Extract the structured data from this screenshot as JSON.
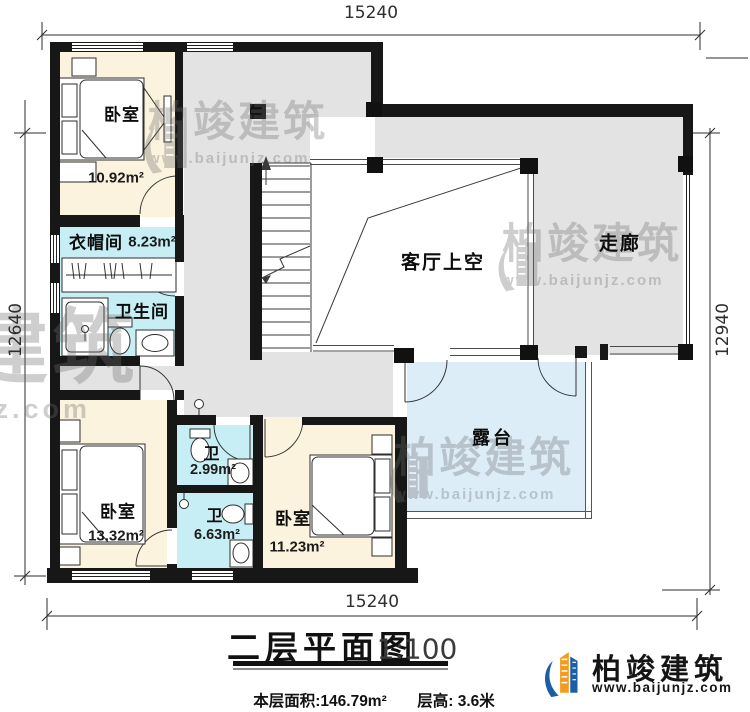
{
  "dimensions": {
    "top": "15240",
    "bottom": "15240",
    "left": "12640",
    "right": "12940"
  },
  "rooms": {
    "bedroom_top_left": {
      "name": "卧室",
      "area": "10.92m²"
    },
    "cloakroom": {
      "name": "衣帽间",
      "area": "8.23m²"
    },
    "bathroom": {
      "name": "卫生间"
    },
    "living_room_void": {
      "name": "客厅上空"
    },
    "corridor": {
      "name": "走廊"
    },
    "bedroom_bottom_left": {
      "name": "卧室",
      "area": "13.32m²"
    },
    "wc_upper": {
      "name": "卫",
      "area": "2.99m²"
    },
    "wc_lower": {
      "name": "卫",
      "area": "6.63m²"
    },
    "bedroom_bottom_right": {
      "name": "卧室",
      "area": "11.23m²"
    },
    "terrace": {
      "name": "露台"
    }
  },
  "title_block": {
    "title": "二层平面图",
    "scale": "1:100",
    "area_label": "本层面积:146.79m²",
    "height_label": "层高: 3.6米"
  },
  "logo": {
    "brand": "柏竣建筑",
    "site": "www.baijunjz.com"
  },
  "watermark": {
    "brand": "柏竣建筑",
    "site": "www.baijunjz.com"
  },
  "colors": {
    "wall": "#171717",
    "hall_gray": "#e3e3e3",
    "room_cream": "#fcf3de",
    "room_cyan": "#c8eef5",
    "terrace_blue": "#dcedf8",
    "logo_blue": "#1b5ea6",
    "logo_orange": "#f29b1d",
    "watermark_gray": "#6e6e6e"
  }
}
